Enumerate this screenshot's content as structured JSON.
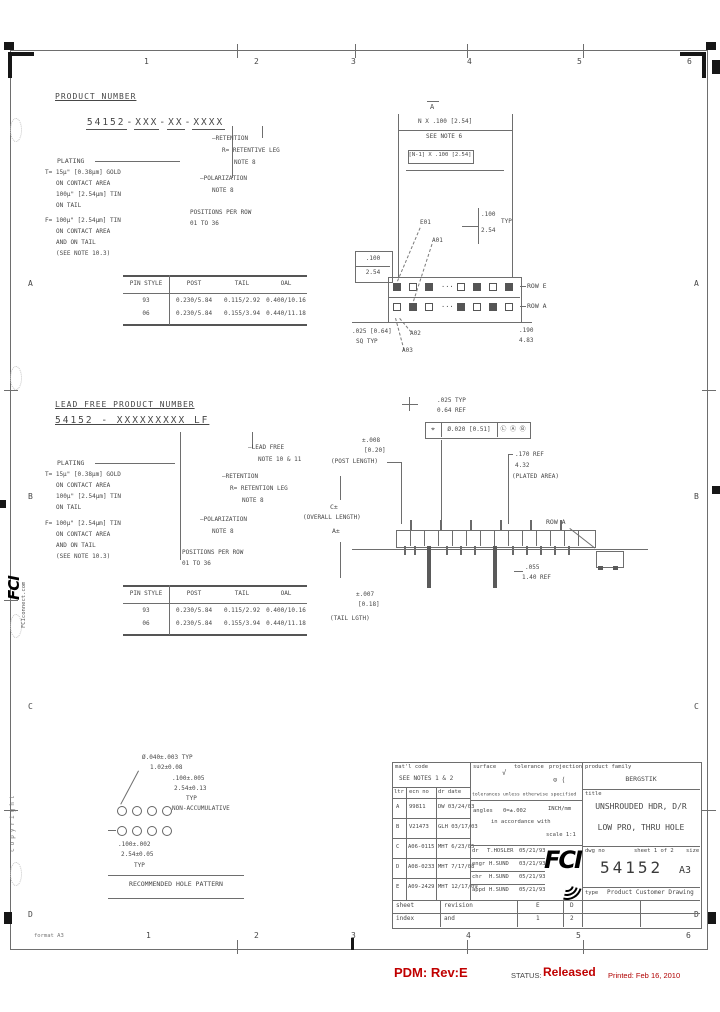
{
  "colors": {
    "ink": "#474747",
    "line": "#6e6e6e",
    "red": "#c00000"
  },
  "zones": {
    "top": [
      "1",
      "2",
      "3",
      "4",
      "5",
      "6"
    ],
    "bottom": [
      "1",
      "2",
      "3",
      "4",
      "5",
      "6"
    ],
    "left": [
      "A",
      "B",
      "C",
      "D"
    ],
    "right": [
      "A",
      "B",
      "C",
      "D"
    ]
  },
  "edge": {
    "logo": "FCI",
    "logo_sub": "FCIconnect.com",
    "copyright": "copyright",
    "format": "format A3"
  },
  "sec1": {
    "title": "PRODUCT NUMBER",
    "pn": {
      "g1": "54152",
      "d1": "-",
      "g2": "XXX",
      "d2": "-",
      "g3": "XX",
      "d3": "-",
      "g4": "XXXX"
    },
    "plating": "PLATING",
    "t1": "T= 15μ\" [0.38μm] GOLD",
    "t2": "ON CONTACT AREA",
    "t3": "100μ\" [2.54μm] TIN",
    "t4": "ON TAIL",
    "f1": "F= 100μ\" [2.54μm] TIN",
    "f2": "ON CONTACT AREA",
    "f3": "AND ON TAIL",
    "f4": "(SEE NOTE 10.3)",
    "r1": "—RETENTION",
    "r2": "R= RETENTIVE LEG",
    "r3": "NOTE 8",
    "p1": "—POLARIZATION",
    "p2": "NOTE 8",
    "pos1": "POSITIONS PER ROW",
    "pos2": "01 TO 36"
  },
  "table1": {
    "h": [
      "PIN STYLE",
      "POST",
      "TAIL",
      "OAL"
    ],
    "rows": [
      [
        "93",
        "0.230/5.84",
        "0.115/2.92",
        "0.400/10.16"
      ],
      [
        "06",
        "0.230/5.84",
        "0.155/3.94",
        "0.440/11.18"
      ]
    ]
  },
  "draw1": {
    "datum": "A",
    "dim1": "N X .100 [2.54]",
    "note": "SEE NOTE 6",
    "dim2": "[N-1] X .100 [2.54]",
    "typ_in": ".100",
    "typ_mm": "2.54",
    "typ": "TYP",
    "box_in": ".100",
    "box_mm": "2.54",
    "rowe": "ROW E",
    "rowa": "ROW A",
    "dots": "···",
    "c1": "E01",
    "c2": "A01",
    "c3": "A02",
    "c4": "A03",
    "sq1": ".025 [0.64]",
    "sq2": "SQ TYP",
    "h_in": ".190",
    "h_mm": "4.83"
  },
  "sec2": {
    "title": "LEAD FREE PRODUCT NUMBER",
    "pn": "54152 - XXXXXXXXX LF",
    "lf1": "—LEAD FREE",
    "lf2": "NOTE 10 & 11",
    "plating": "PLATING",
    "t1": "T= 15μ\" [0.38μm] GOLD",
    "t2": "ON CONTACT AREA",
    "t3": "100μ\" [2.54μm] TIN",
    "t4": "ON TAIL",
    "f1": "F= 100μ\" [2.54μm] TIN",
    "f2": "ON CONTACT AREA",
    "f3": "AND ON TAIL",
    "f4": "(SEE NOTE 10.3)",
    "r1": "—RETENTION",
    "r2": "R= RETENTION LEG",
    "r3": "NOTE 8",
    "p1": "—POLARIZATION",
    "p2": "NOTE 8",
    "pos1": "POSITIONS PER ROW",
    "pos2": "01 TO 36"
  },
  "table2": {
    "h": [
      "PIN STYLE",
      "POST",
      "TAIL",
      "OAL"
    ],
    "rows": [
      [
        "93",
        "0.230/5.84",
        "0.115/2.92",
        "0.400/10.16"
      ],
      [
        "06",
        "0.230/5.84",
        "0.155/3.94",
        "0.440/11.18"
      ]
    ]
  },
  "draw2": {
    "sq1": ".025 TYP",
    "sq2": "0.64 REF",
    "gdt_sym": "⌖",
    "gdt_tol": "Ø.020 [0.51]",
    "gdt_ref": "Ⓛ Ⓐ Ⓑ",
    "pl1": "±.008",
    "pl2": "[0.20]",
    "pl3": "(POST LENGTH)",
    "pa1": ".170 REF",
    "pa2": "4.32",
    "pa3": "(PLATED AREA)",
    "oal1": "C±",
    "oal2": "(OVERALL LENGTH)",
    "oal3": "A±",
    "rowa": "ROW A",
    "tl1": "±.007",
    "tl2": "[0.18]",
    "tl3": "(TAIL LGTH)",
    "rf1": ".055",
    "rf2": "1.40 REF"
  },
  "hole": {
    "d1": "Ø.040±.003 TYP",
    "d2": "1.02±0.08",
    "p1": ".100±.005",
    "p2": "2.54±0.13",
    "p3": "TYP",
    "p4": "NON-ACCUMULATIVE",
    "r1": ".100±.002",
    "r2": "2.54±0.05",
    "r3": "TYP",
    "title": "RECOMMENDED HOLE PATTERN"
  },
  "tb": {
    "matl_label": "mat'l code",
    "matl": "SEE NOTES 1 & 2",
    "rh": [
      "ltr",
      "ecn no",
      "dr date"
    ],
    "revs": [
      [
        "A",
        "99811",
        "DW 03/24/03"
      ],
      [
        "B",
        "V21473",
        "GLH 03/17/03"
      ],
      [
        "C",
        "A06-0115",
        "MHT 6/23/05"
      ],
      [
        "D",
        "A08-0233",
        "MHT 7/17/08"
      ],
      [
        "E",
        "A09-2429",
        "MHT 12/17/09"
      ]
    ],
    "surface": "surface",
    "surf_sym": "√",
    "tolerance": "tolerance",
    "projection": "projection",
    "proj_sym": "⊙ ⟨",
    "tol_note": "tolerances unless otherwise specified",
    "angles": "angles",
    "tolv": "0=±.002",
    "units": "INCH/mm",
    "accord": "in accordance with",
    "scale": "scale 1:1",
    "sigs": [
      [
        "dr",
        "T.HOSLER",
        "05/21/93"
      ],
      [
        "engr",
        "H.SUND",
        "03/21/93"
      ],
      [
        "chr",
        "H.SUND",
        "05/21/93"
      ],
      [
        "appd",
        "H.SUND",
        "05/21/93"
      ]
    ],
    "logo": "FCI",
    "family_label": "product family",
    "family": "BERGSTIK",
    "title_label": "title",
    "t1": "UNSHROUDED HDR, D/R",
    "t2": "LOW PRO, THRU HOLE",
    "dwg_label": "dwg no",
    "sheet": "sheet 1 of 2",
    "size_label": "size",
    "dwg": "54152",
    "size": "A3",
    "type_label": "type",
    "type": "Product Customer Drawing",
    "strip": [
      [
        "sheet",
        "revision",
        "E",
        "D"
      ],
      [
        "index",
        "and",
        "1",
        "2"
      ]
    ]
  },
  "footer": {
    "pdm": "PDM: Rev:E",
    "sl": "STATUS:",
    "status": "Released",
    "printed": "Printed: Feb 16, 2010"
  }
}
